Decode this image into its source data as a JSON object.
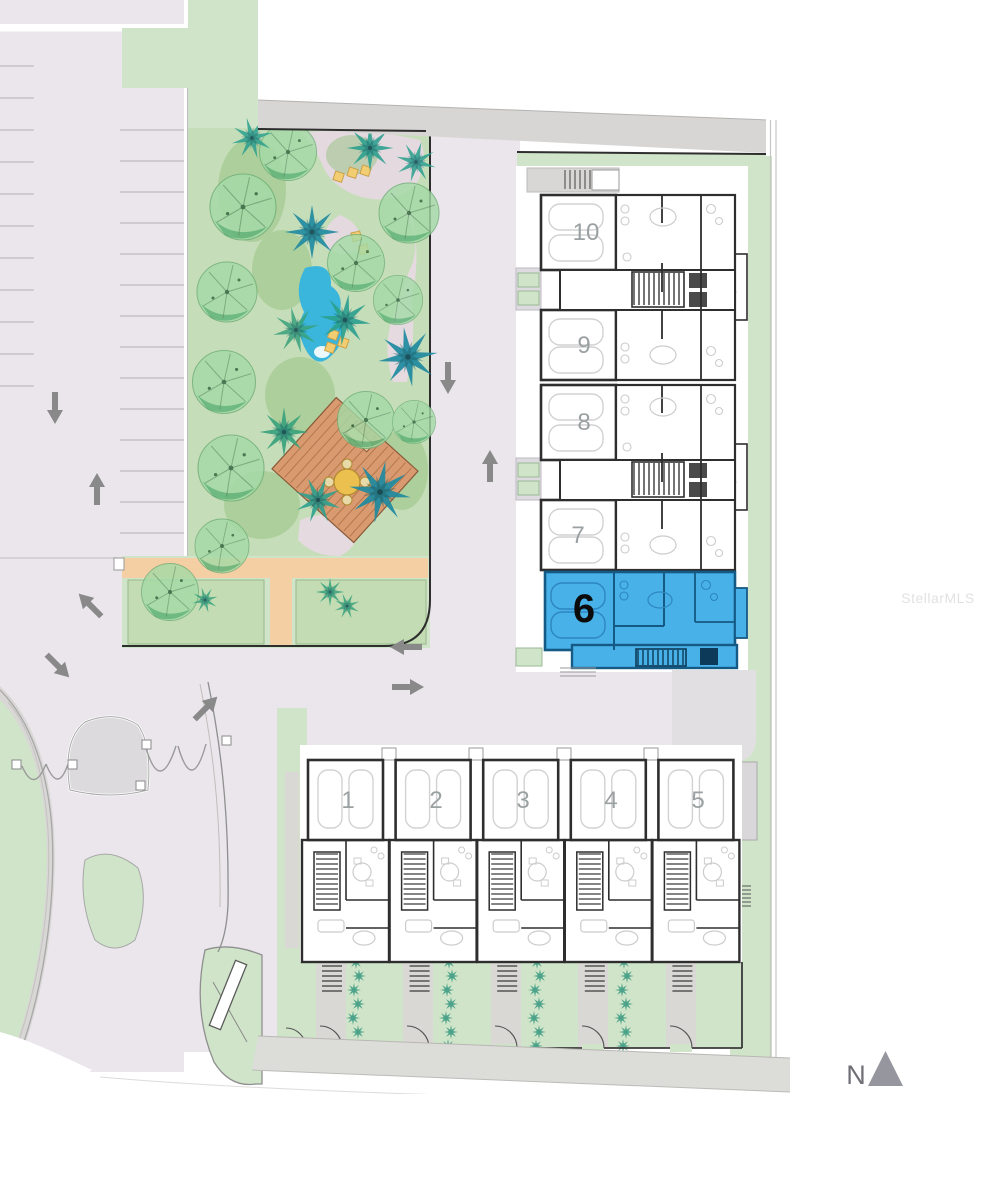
{
  "watermark": {
    "text": "StellarMLS"
  },
  "compass": {
    "label": "N"
  },
  "site": {
    "highlighted_unit": "6",
    "units_row_top": [
      "10",
      "9",
      "8",
      "7",
      "6"
    ],
    "units_row_bottom": [
      "1",
      "2",
      "3",
      "4",
      "5"
    ]
  },
  "units": {
    "u1": {
      "label": "1"
    },
    "u2": {
      "label": "2"
    },
    "u3": {
      "label": "3"
    },
    "u4": {
      "label": "4"
    },
    "u5": {
      "label": "5"
    },
    "u6": {
      "label": "6"
    },
    "u7": {
      "label": "7"
    },
    "u8": {
      "label": "8"
    },
    "u9": {
      "label": "9"
    },
    "u10": {
      "label": "10"
    }
  },
  "colors": {
    "highlight_fill": "#48b1e8",
    "highlight_wall": "#155a84",
    "pavement": "#eae6ec",
    "green": "#cfe4c8",
    "garden_green": "#c6ddb9",
    "road_gray": "#d8d6d4",
    "pond_blue": "#3ab5dc",
    "deck_brown": "#d89a6e",
    "path_pink": "#e7d9e3",
    "peach_path": "#f4cfa4",
    "wall": "#2e2e2e",
    "arrow_gray": "#898989",
    "tree_green": "#a4dba6",
    "palm_teal": "#2ba08e"
  }
}
